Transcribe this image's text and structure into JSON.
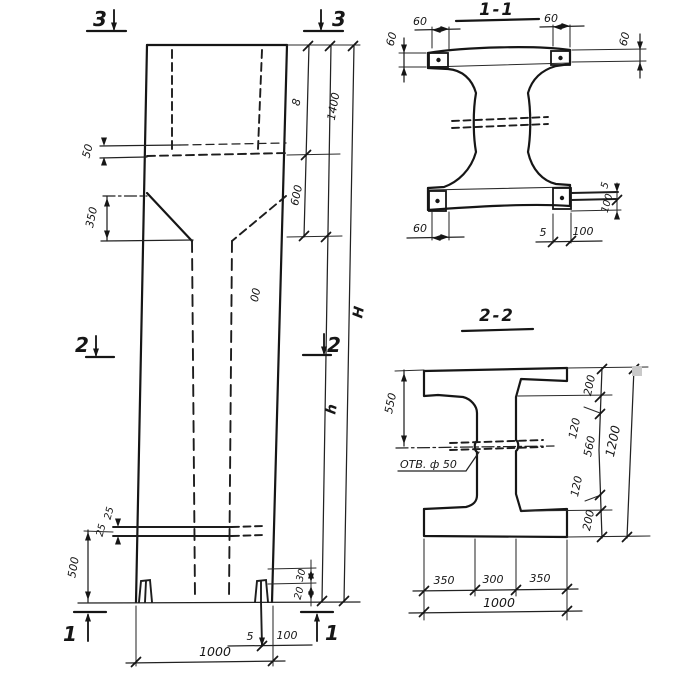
{
  "marks": {
    "top_left": "3",
    "top_right": "3",
    "mid_left": "2",
    "mid_right": "2",
    "bottom_left": "1",
    "bottom_right": "1"
  },
  "elevation": {
    "dim_50": "50",
    "dim_350": "350",
    "dim_25_upper": "25",
    "dim_25_lower": "25",
    "dim_500": "500",
    "dim_800": "800",
    "dim_600": "600",
    "dim_1400": "1400",
    "dim_H": "H",
    "dim_h": "h",
    "dim_30": "30",
    "dim_20": "20",
    "dim_5": "5",
    "dim_100": "100",
    "dim_1000": "1000"
  },
  "section_1_1": {
    "title": "1-1",
    "dim_60_top_left": "60",
    "dim_60_top_right": "60",
    "dim_60_left": "60",
    "dim_60_right": "60",
    "dim_60_bottom": "60",
    "dim_5_bottom": "5",
    "dim_100_bottom": "100",
    "dim_5_right": "5",
    "dim_100_right": "100"
  },
  "section_2_2": {
    "title": "2-2",
    "hole_label": "ОТВ. ф 50",
    "dim_550": "550",
    "dim_200_top": "200",
    "dim_120_top": "120",
    "dim_560": "560",
    "dim_120_bottom": "120",
    "dim_200_bottom": "200",
    "dim_1200": "1200",
    "dim_350_left": "350",
    "dim_300": "300",
    "dim_350_right": "350",
    "dim_1000": "1000"
  }
}
